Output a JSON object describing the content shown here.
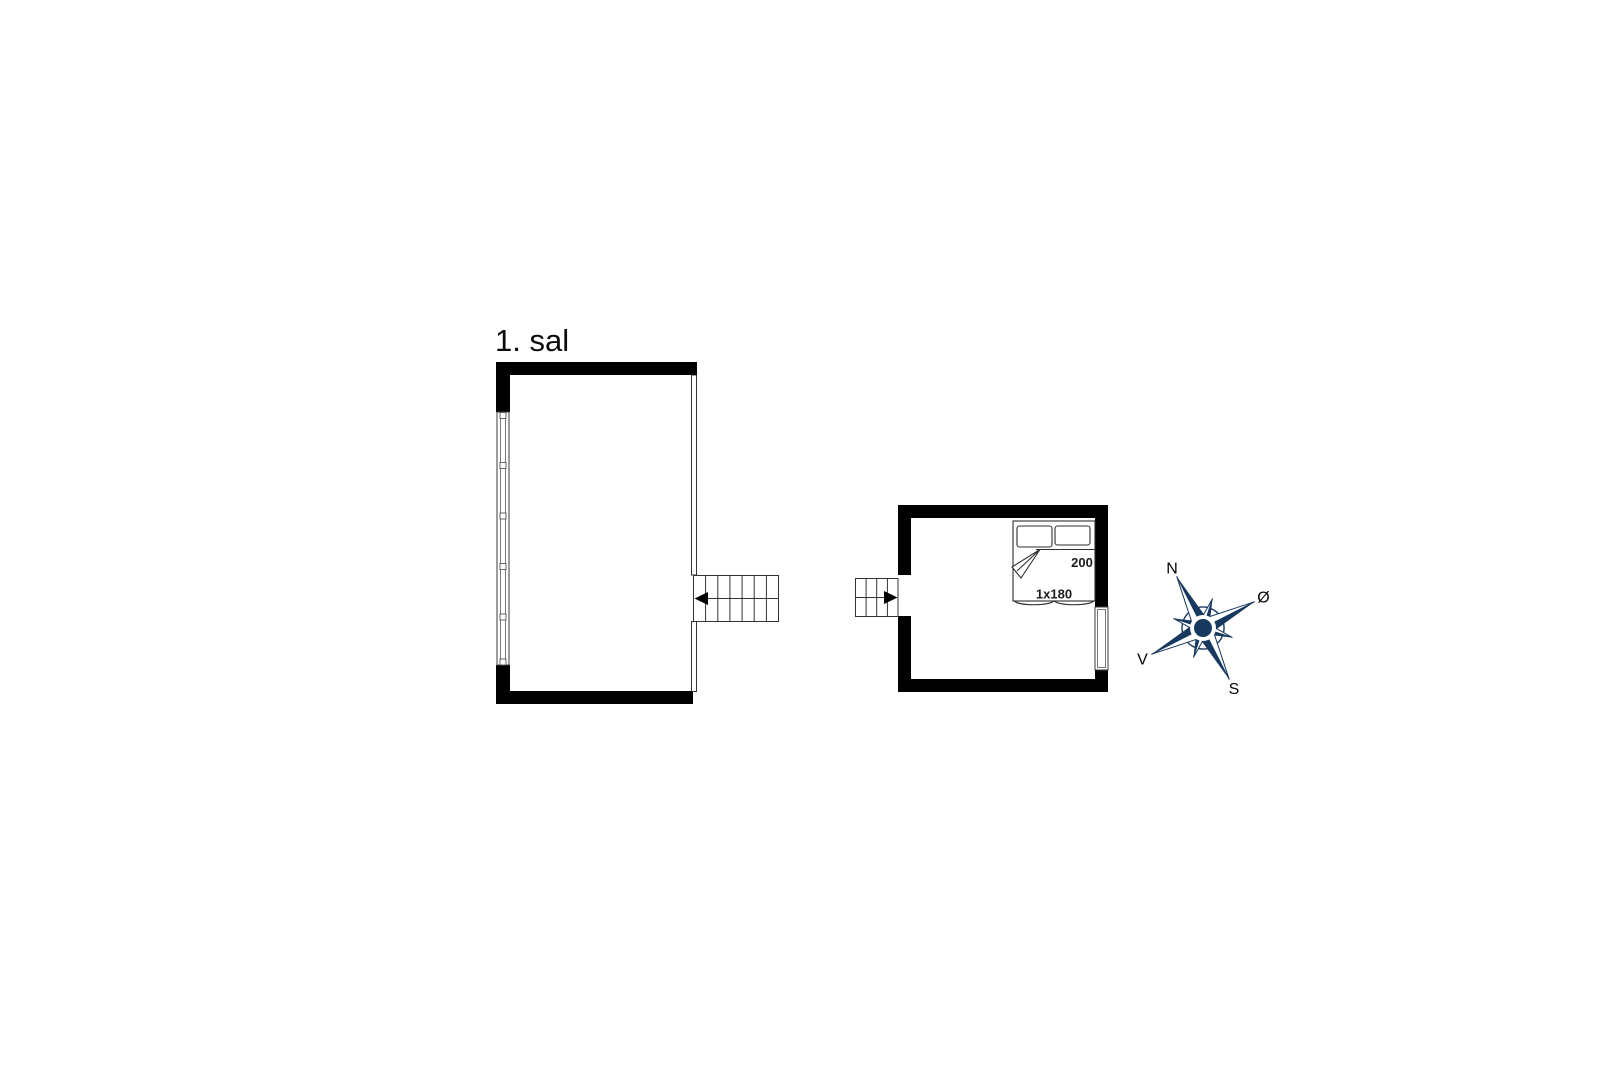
{
  "floor": {
    "label": "1. sal"
  },
  "bedroom": {
    "bed": {
      "length_label": "200",
      "size_label": "1x180"
    }
  },
  "compass": {
    "north_label": "N",
    "east_label": "Ø",
    "south_label": "S",
    "west_label": "V",
    "color": "#18395f"
  },
  "colors": {
    "background": "#ffffff",
    "walls": "#000000",
    "linework": "#2e2e2e"
  }
}
